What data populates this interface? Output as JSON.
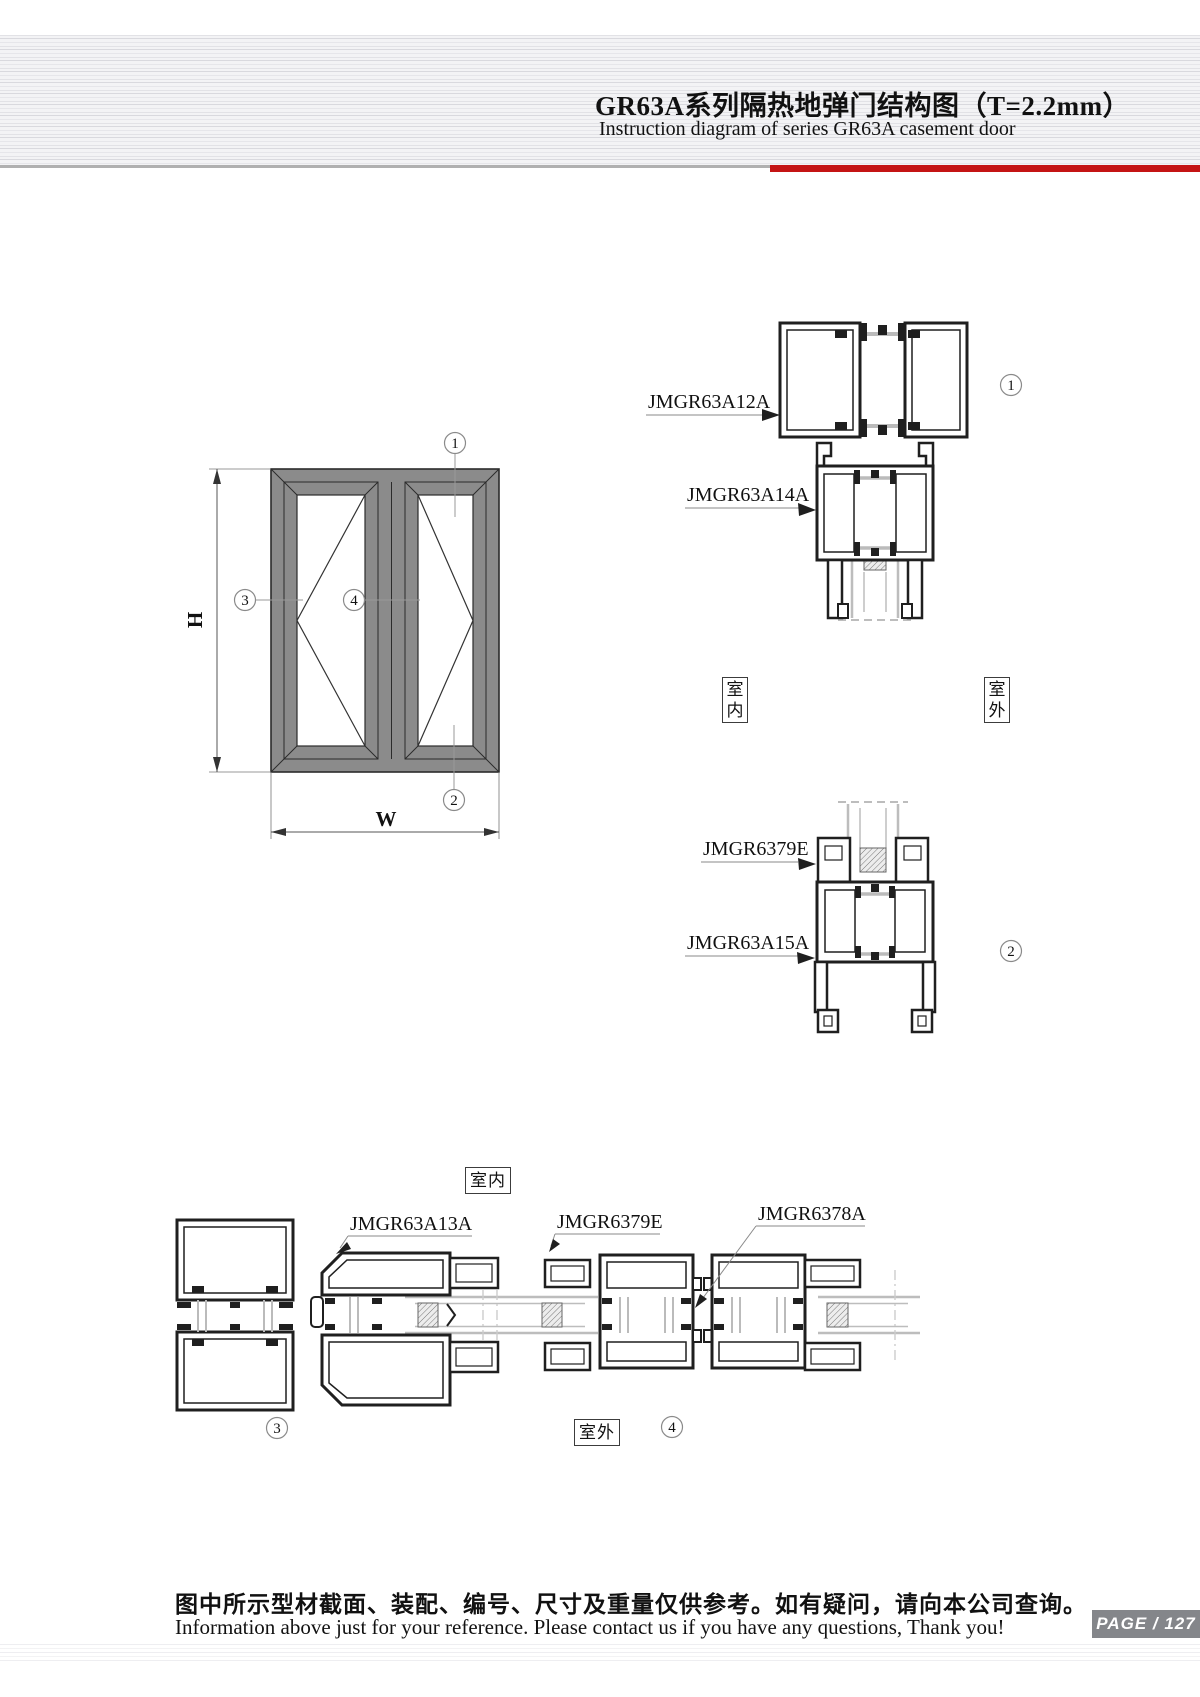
{
  "header": {
    "title_cn": "GR63A系列隔热地弹门结构图（T=2.2mm）",
    "title_en": "Instruction diagram of series GR63A casement door"
  },
  "elevation": {
    "height_label": "H",
    "width_label": "W",
    "callout_top": "1",
    "callout_bottom": "2",
    "callout_frame": "3",
    "callout_mullion": "4"
  },
  "section1": {
    "part1_code": "JMGR63A12A",
    "part2_code": "JMGR63A14A",
    "callout": "1",
    "indoor_label": "室内",
    "outdoor_label": "室外"
  },
  "section2": {
    "part1_code": "JMGR6379E",
    "part2_code": "JMGR63A15A",
    "callout": "2"
  },
  "plan": {
    "part1_code": "JMGR63A13A",
    "part2_code": "JMGR6379E",
    "part3_code": "JMGR6378A",
    "callout_jamb": "3",
    "callout_meeting": "4",
    "indoor_label": "室内",
    "outdoor_label": "室外"
  },
  "footer": {
    "note_cn": "图中所示型材截面、装配、编号、尺寸及重量仅供参考。如有疑问，请向本公司查询。",
    "note_en": "Information above just for your reference. Please contact us if you have any questions, Thank you!",
    "page_text": "PAGE / 127"
  },
  "colors": {
    "accent_red": "#c41414",
    "frame_gray": "#8b8b8b",
    "profile_line": "#1f1f1f",
    "glass_line": "#bdbdbd"
  }
}
